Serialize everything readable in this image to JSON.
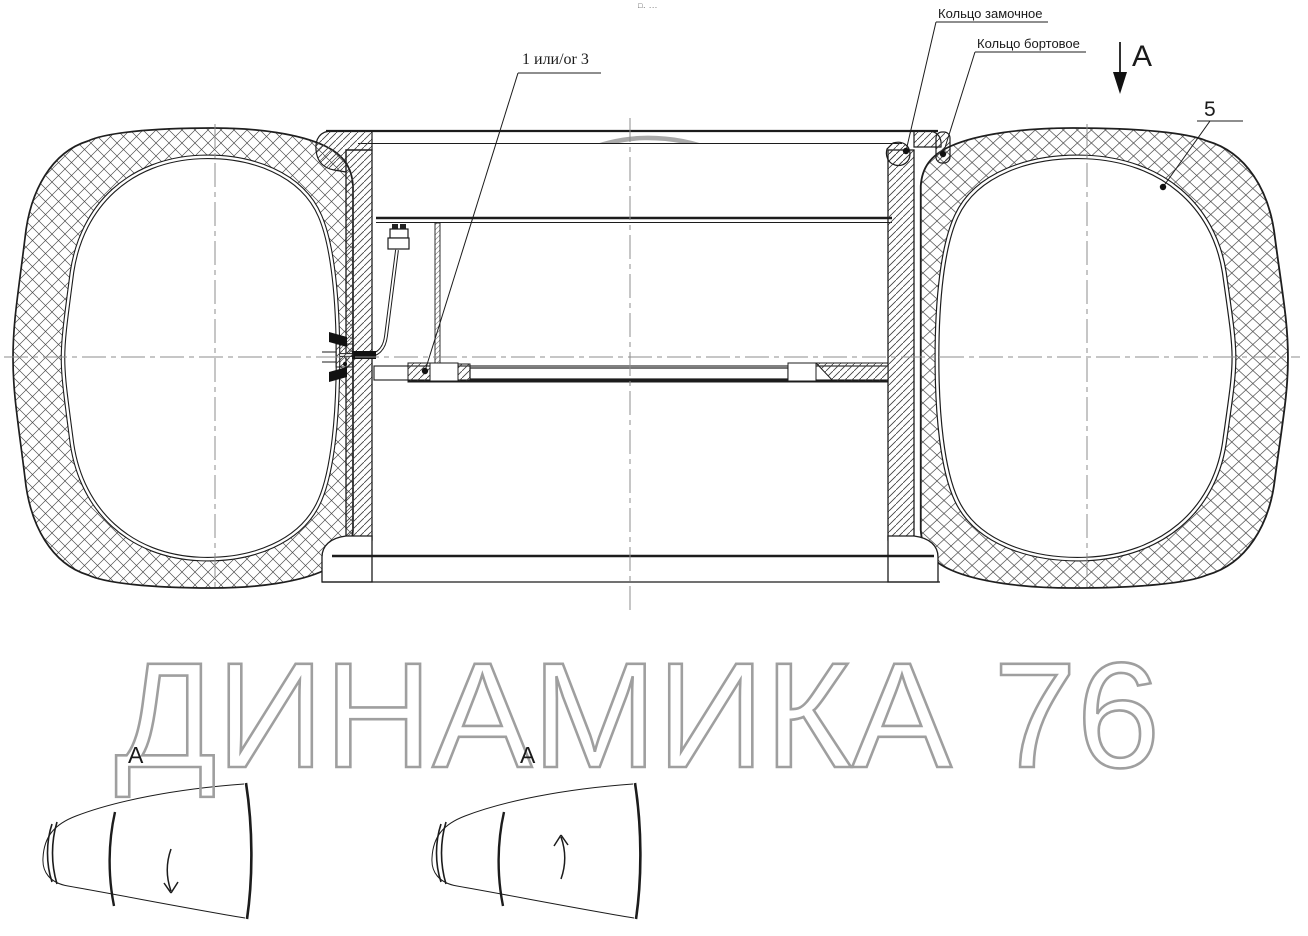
{
  "drawing": {
    "callouts": {
      "lock_ring": "Кольцо замочное",
      "bead_ring": "Кольцо бортовое",
      "item_1_or_3": "1 или/or 3",
      "item_5": "5"
    },
    "section_marker": "A",
    "views": {
      "left_label": "A",
      "right_label": "A"
    },
    "tiny_marks": "□. ...",
    "colors": {
      "line": "#1c1c1c",
      "centerline": "#8c8c8c",
      "watermark_text": "#9f9f9f",
      "watermark_logo": "#9b9b9b"
    }
  },
  "watermark": {
    "text": "ДИНАМИКА 76"
  }
}
